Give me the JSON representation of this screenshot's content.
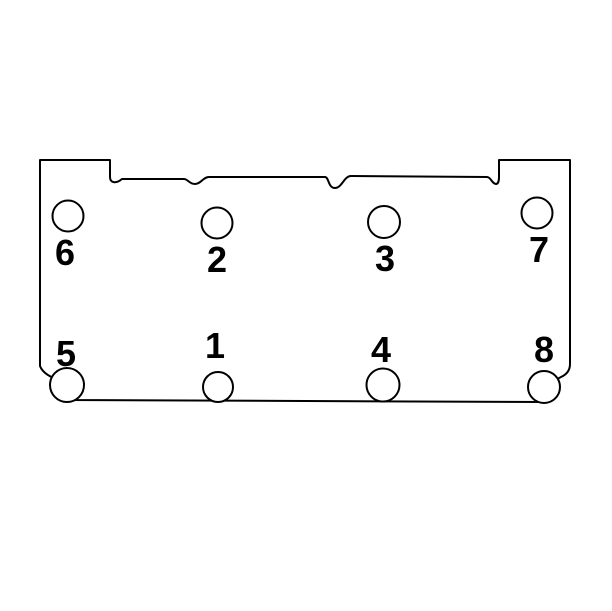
{
  "figure": {
    "description": "Cylinder head bolt hole diagram with numbered tightening sequence 1-8",
    "line_color": "#000000",
    "background_color": "#ffffff",
    "bolts": [
      {
        "label": "1",
        "cx": 218,
        "cy": 387,
        "r": 15,
        "lx": 215,
        "ly": 358
      },
      {
        "label": "2",
        "cx": 217,
        "cy": 223,
        "r": 15.5,
        "lx": 217,
        "ly": 272
      },
      {
        "label": "3",
        "cx": 384,
        "cy": 222,
        "r": 16,
        "lx": 385,
        "ly": 271
      },
      {
        "label": "4",
        "cx": 383,
        "cy": 385,
        "r": 16.5,
        "lx": 381,
        "ly": 362
      },
      {
        "label": "5",
        "cx": 67,
        "cy": 385,
        "r": 17,
        "lx": 66,
        "ly": 366
      },
      {
        "label": "6",
        "cx": 68,
        "cy": 216,
        "r": 15.5,
        "lx": 65,
        "ly": 265
      },
      {
        "label": "7",
        "cx": 537,
        "cy": 213,
        "r": 15.5,
        "lx": 539,
        "ly": 262
      },
      {
        "label": "8",
        "cx": 544,
        "cy": 387,
        "r": 16,
        "lx": 544,
        "ly": 362
      }
    ]
  }
}
